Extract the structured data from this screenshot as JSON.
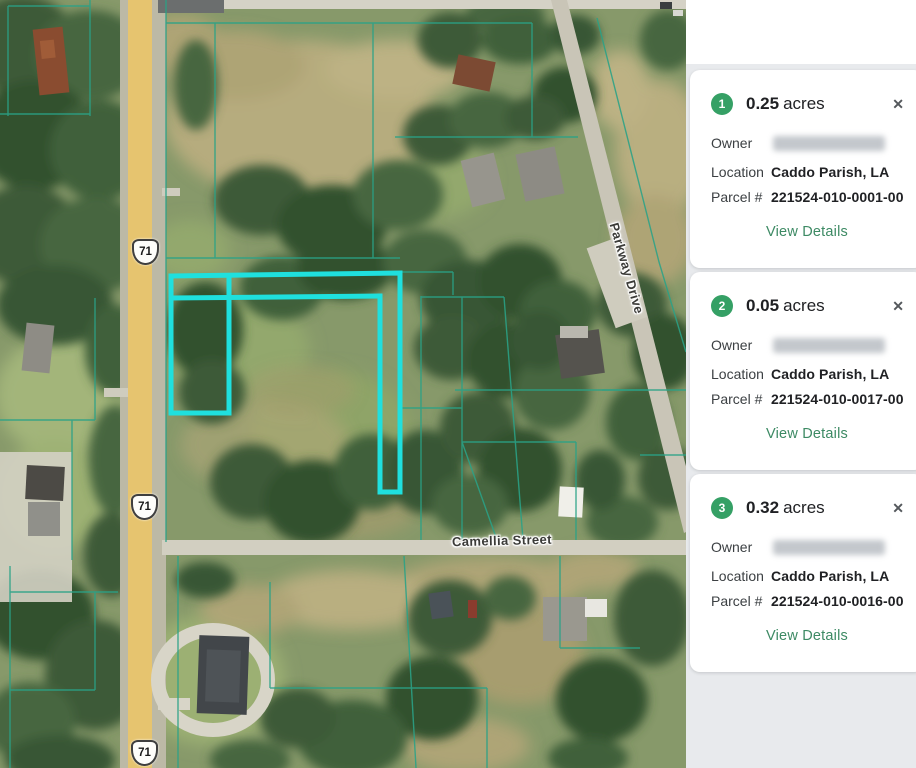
{
  "map": {
    "highway_shield": "71",
    "street_labels": {
      "camellia": "Camellia Street",
      "parkway": "Parkway Drive"
    },
    "colors": {
      "parcel_highlight": "#1FE0DE",
      "parcel_line": "#2AA287",
      "badge_green": "#35A065"
    }
  },
  "sidebar": {
    "labels": {
      "owner": "Owner",
      "location": "Location",
      "parcel_number": "Parcel #",
      "view_details": "View Details",
      "close": "✕"
    },
    "cards": [
      {
        "index": "1",
        "acres": "0.25",
        "unit": "acres",
        "location": "Caddo Parish, LA",
        "parcel_number": "221524-010-0001-00"
      },
      {
        "index": "2",
        "acres": "0.05",
        "unit": "acres",
        "location": "Caddo Parish, LA",
        "parcel_number": "221524-010-0017-00"
      },
      {
        "index": "3",
        "acres": "0.32",
        "unit": "acres",
        "location": "Caddo Parish, LA",
        "parcel_number": "221524-010-0016-00"
      }
    ]
  }
}
